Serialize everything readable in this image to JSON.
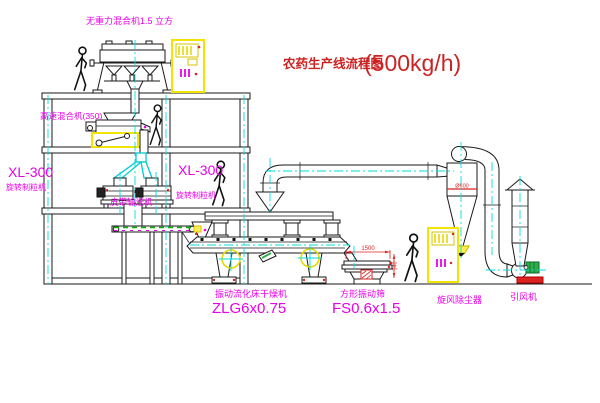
{
  "title": {
    "text": "农药生产线流程图",
    "capacity": "(500kg/h)"
  },
  "equipment": {
    "gravity_free_mixer": {
      "label": "无重力混合机1.5 立方"
    },
    "high_speed_mixer": {
      "label": "高速混合机(350)"
    },
    "granulator_left": {
      "model": "XL-300",
      "name": "旋转制粒机"
    },
    "granulator_center": {
      "model": "XL-300",
      "name": "旋转制粒机"
    },
    "belt_conveyor": {
      "name": "皮带输送机"
    },
    "fluid_bed_dryer": {
      "name": "振动流化床干燥机",
      "model": "ZLG6x0.75"
    },
    "vibrating_sieve": {
      "name": "方形振动筛",
      "model": "FS0.6x1.5",
      "dim_length": "1500",
      "dim_height": "540"
    },
    "cyclone": {
      "name": "旋风除尘器",
      "dim_diameter": "Ø600"
    },
    "induced_draft_fan": {
      "name": "引风机"
    }
  },
  "colors": {
    "label_magenta": "#e800e8",
    "title_red": "#cc2222",
    "line_black": "#1a1a1a",
    "centerline_cyan": "#00dede",
    "cabinet_yellow": "#f2e400",
    "belt_green": "#00b400",
    "motor_green": "#2fae4a",
    "base_red": "#dd2222"
  }
}
